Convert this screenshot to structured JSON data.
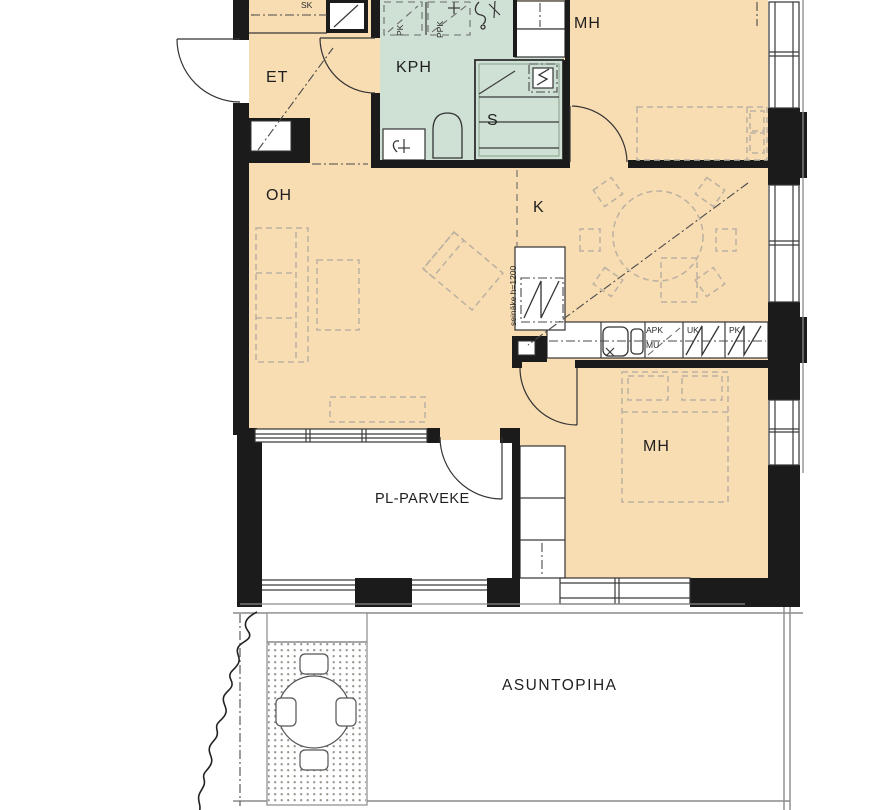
{
  "plan": {
    "rooms": {
      "entry": "ET",
      "bathroom": "KPH",
      "sauna": "S",
      "bedroom1": "MH",
      "living": "OH",
      "kitchen": "K",
      "bedroom2": "MH",
      "balcony": "PL-PARVEKE",
      "yard": "ASUNTOPIHA"
    },
    "small_labels": {
      "closet": "SK",
      "washer": "PK",
      "dryer": "PPK",
      "dishwasher": "APK",
      "microwave": "MU",
      "oven_unit": "UK",
      "freezer_unit": "PK",
      "partition_note": "seinäke h=1200"
    },
    "colors": {
      "floor": "#f8dcb2",
      "wet": "#cfe0d4",
      "wall": "#1b1b1b",
      "paper": "#ffffff",
      "furniture": "#bbb1a1",
      "site_line": "#8a8a8a",
      "text": "#1f1f1f"
    }
  }
}
